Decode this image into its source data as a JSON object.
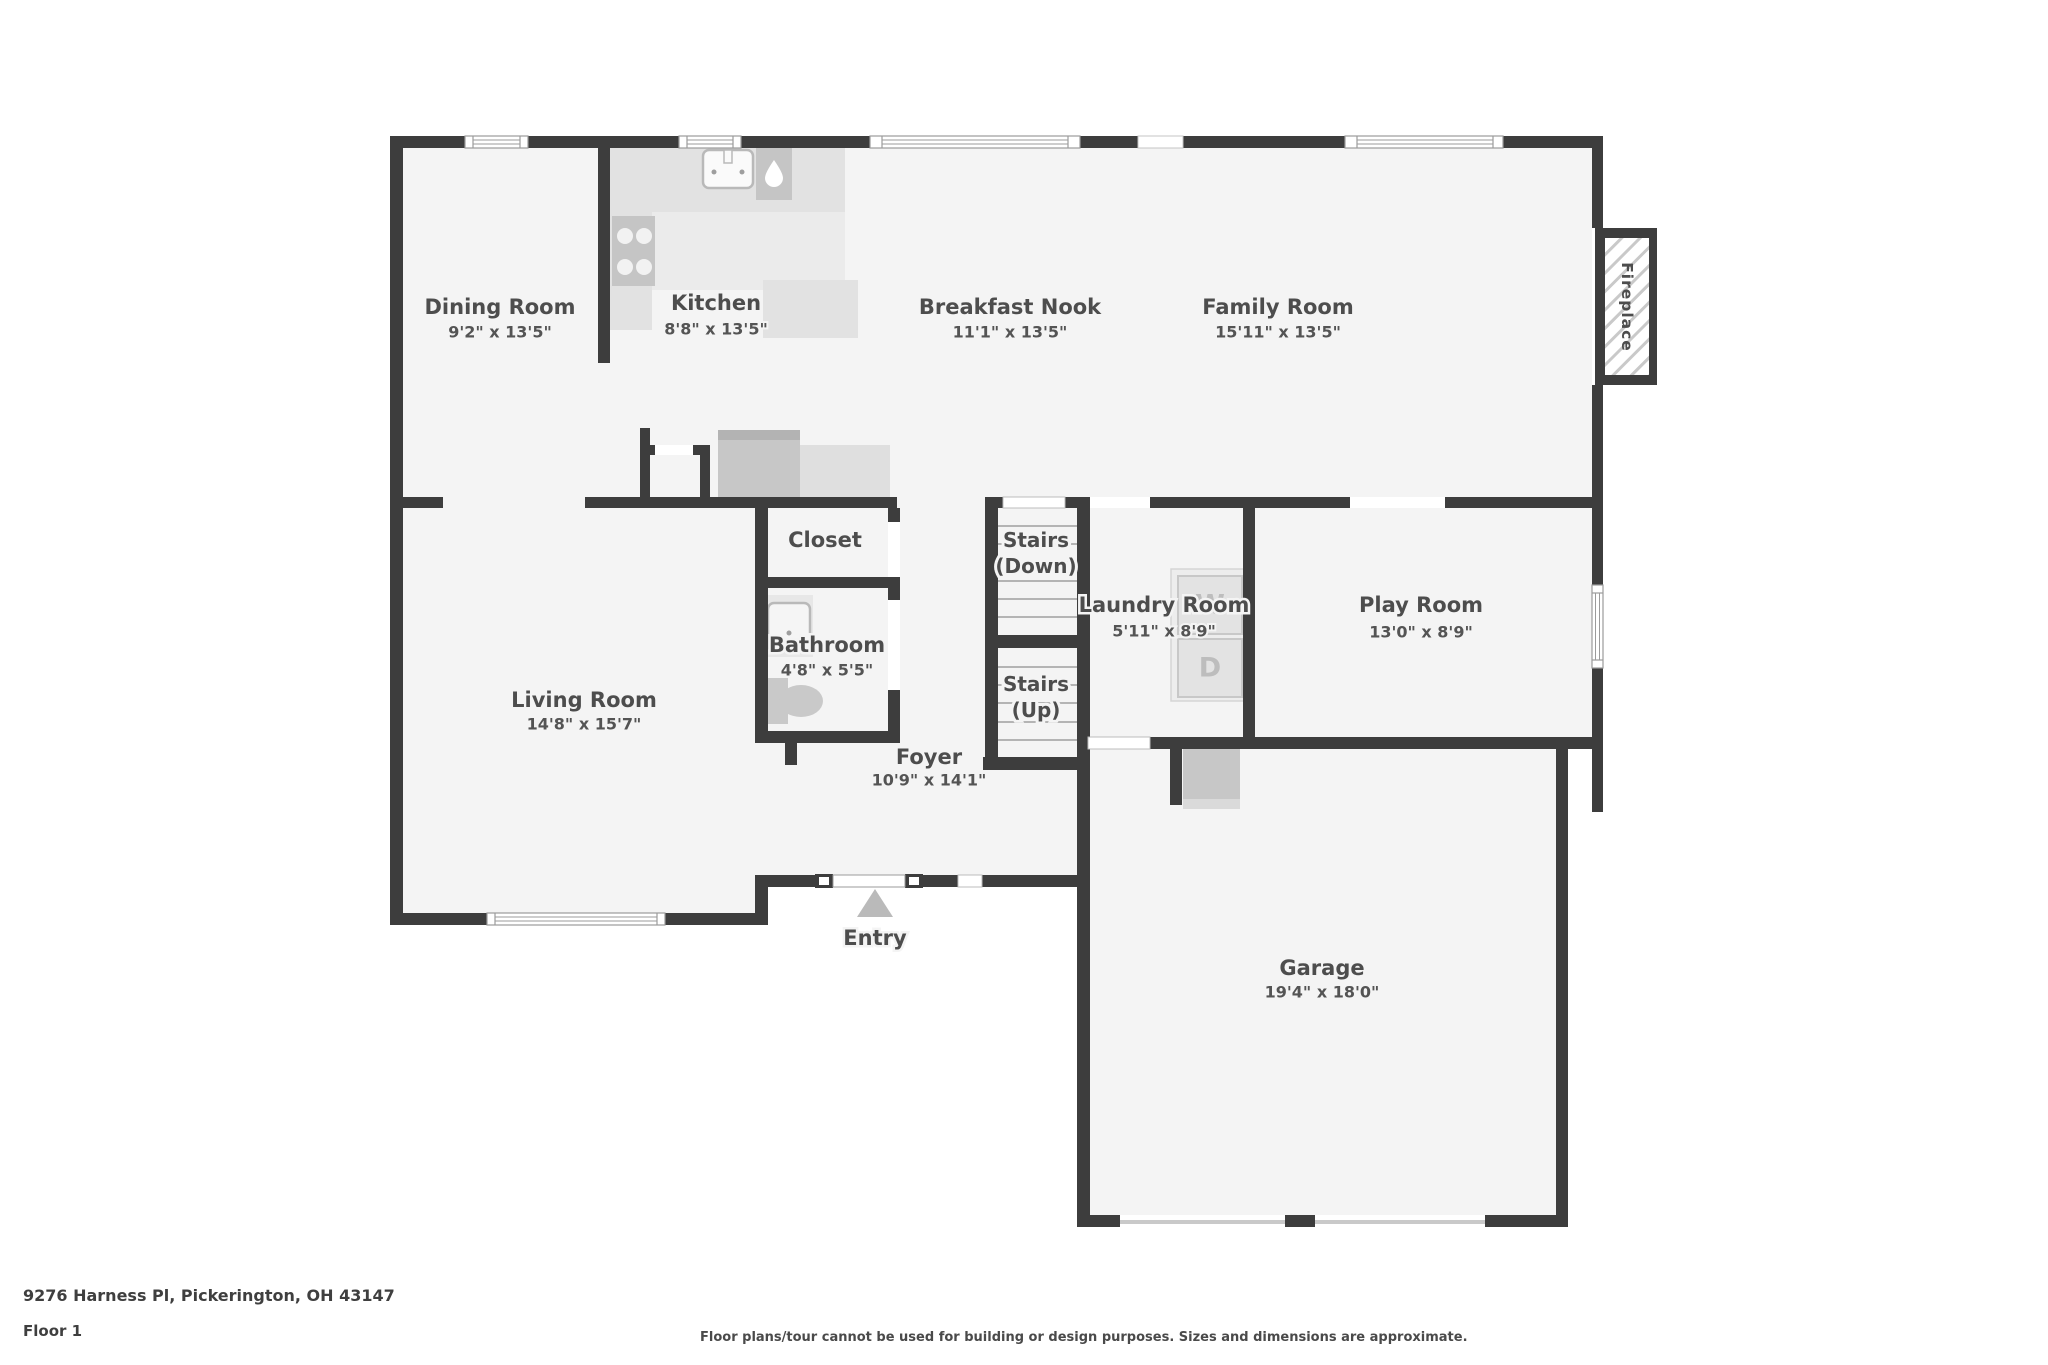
{
  "meta": {
    "address": "9276 Harness Pl, Pickerington, OH 43147",
    "floor": "Floor 1",
    "disclaimer": "Floor plans/tour cannot be used for building or design purposes. Sizes and dimensions are approximate."
  },
  "rooms": {
    "dining": {
      "name": "Dining Room",
      "dims": "9'2\" x 13'5\""
    },
    "kitchen": {
      "name": "Kitchen",
      "dims": "8'8\" x 13'5\""
    },
    "breakfast": {
      "name": "Breakfast Nook",
      "dims": "11'1\" x 13'5\""
    },
    "family": {
      "name": "Family Room",
      "dims": "15'11\" x 13'5\""
    },
    "living": {
      "name": "Living Room",
      "dims": "14'8\" x 15'7\""
    },
    "closet": {
      "name": "Closet"
    },
    "bathroom": {
      "name": "Bathroom",
      "dims": "4'8\" x 5'5\""
    },
    "foyer": {
      "name": "Foyer",
      "dims": "10'9\" x 14'1\""
    },
    "stairs_down": {
      "line1": "Stairs",
      "line2": "(Down)"
    },
    "stairs_up": {
      "line1": "Stairs",
      "line2": "(Up)"
    },
    "laundry": {
      "name": "Laundry Room",
      "dims": "5'11\" x 8'9\""
    },
    "play": {
      "name": "Play Room",
      "dims": "13'0\" x 8'9\""
    },
    "garage": {
      "name": "Garage",
      "dims": "19'4\" x 18'0\""
    }
  },
  "labels": {
    "entry": "Entry",
    "fireplace": "Fireplace",
    "washer": "W",
    "dryer": "D"
  },
  "colors": {
    "wall": "#3d3d3d",
    "floor": "#f4f4f4",
    "counter": "#e2e2e2",
    "appliance": "#c5c5c5",
    "text": "#4d4d4d"
  }
}
